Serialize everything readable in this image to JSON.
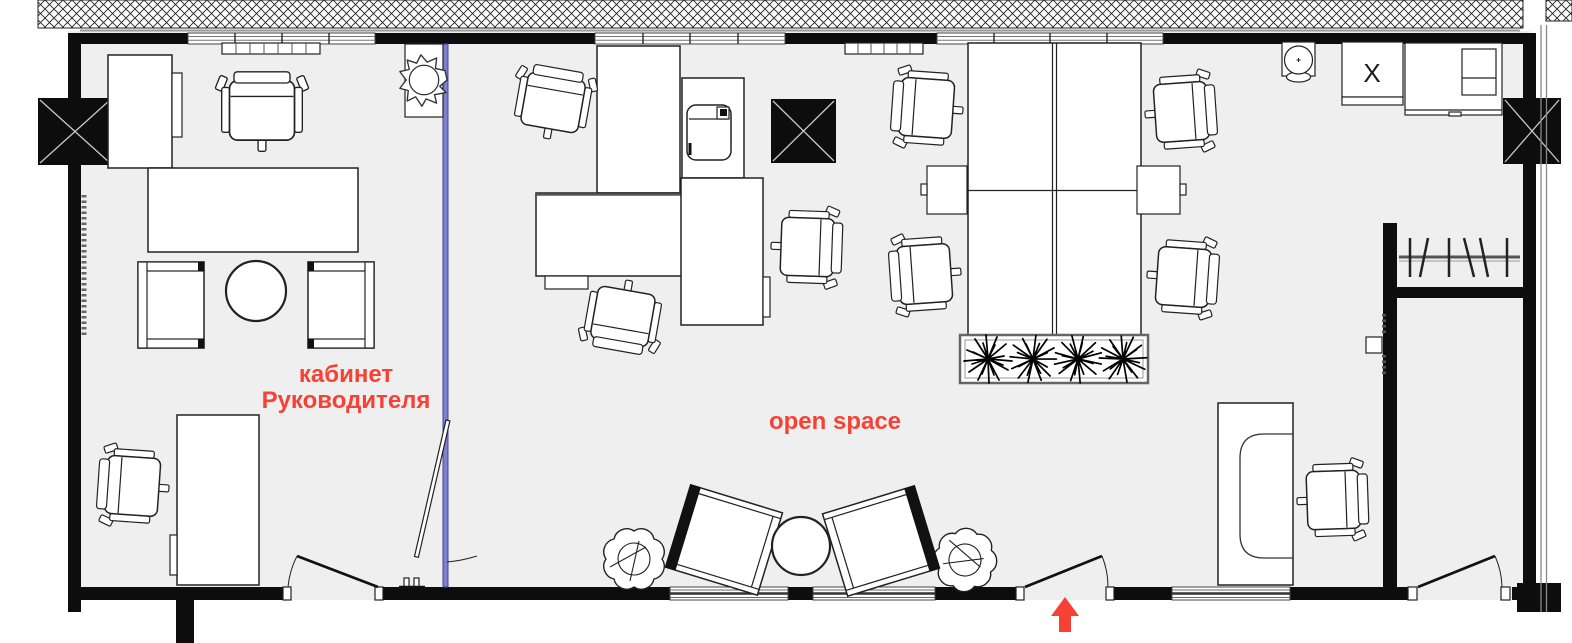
{
  "plan": {
    "rooms": [
      {
        "id": "director-office",
        "label_line1": "кабинет",
        "label_line2": "Руководителя"
      },
      {
        "id": "open-space",
        "label": "open space"
      }
    ],
    "markers": {
      "storage_box_label": "X"
    },
    "colors": {
      "label_red": "#f74134",
      "arrow_red": "#f74134",
      "partition_blue": "#7d82cf",
      "wall_black": "#0d0d0d",
      "floor_gray": "#efefef"
    },
    "furniture_icons": [
      "executive-desk",
      "executive-chair",
      "meeting-table",
      "guest-armchair",
      "coffee-table",
      "office-desk",
      "office-chair",
      "printer",
      "storage-cabinet",
      "round-plant",
      "leafy-plant",
      "planter-box",
      "water-cooler",
      "kitchen-cabinet",
      "coat-rack",
      "reception-desk",
      "lounge-armchair",
      "round-table",
      "entrance-door",
      "glass-partition",
      "structural-column",
      "radiator",
      "electrical-panel"
    ]
  }
}
